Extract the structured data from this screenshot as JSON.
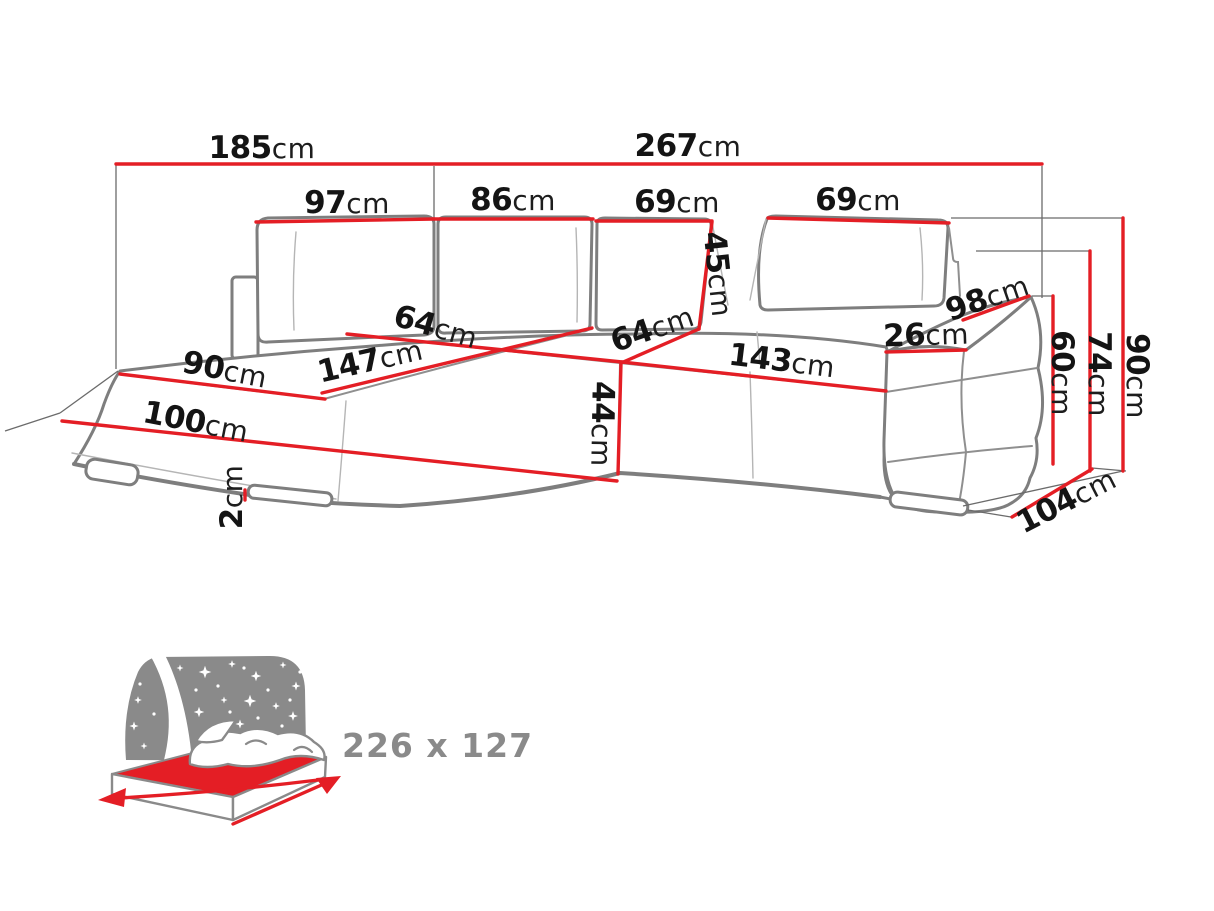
{
  "unit": "cm",
  "colors": {
    "dimension_red": "#e41e25",
    "sketch_gray": "#7e7e7e",
    "icon_gray": "#8a8a8a",
    "label_black": "#141414",
    "background": "#ffffff"
  },
  "icons": {
    "sleeping_function": "bed-under-starry-night-icon"
  },
  "m": {
    "left_span": "185",
    "total_width": "267",
    "back_cushion_1": "97",
    "back_cushion_2": "86",
    "back_cushion_3": "69",
    "back_cushion_4": "69",
    "back_cushion_height": "45",
    "seat_depth_left": "64",
    "chaise_seat_length": "147",
    "seat_depth_right": "64",
    "seat_front_height": "44",
    "seat_length_right": "143",
    "armrest_width": "26",
    "armrest_depth": "98",
    "chaise_width": "90",
    "chaise_front_length": "100",
    "leg_height": "2",
    "armrest_height": "60",
    "backrest_height": "74",
    "total_height": "90",
    "total_depth": "104"
  },
  "bed": {
    "size": "226 x 127"
  }
}
